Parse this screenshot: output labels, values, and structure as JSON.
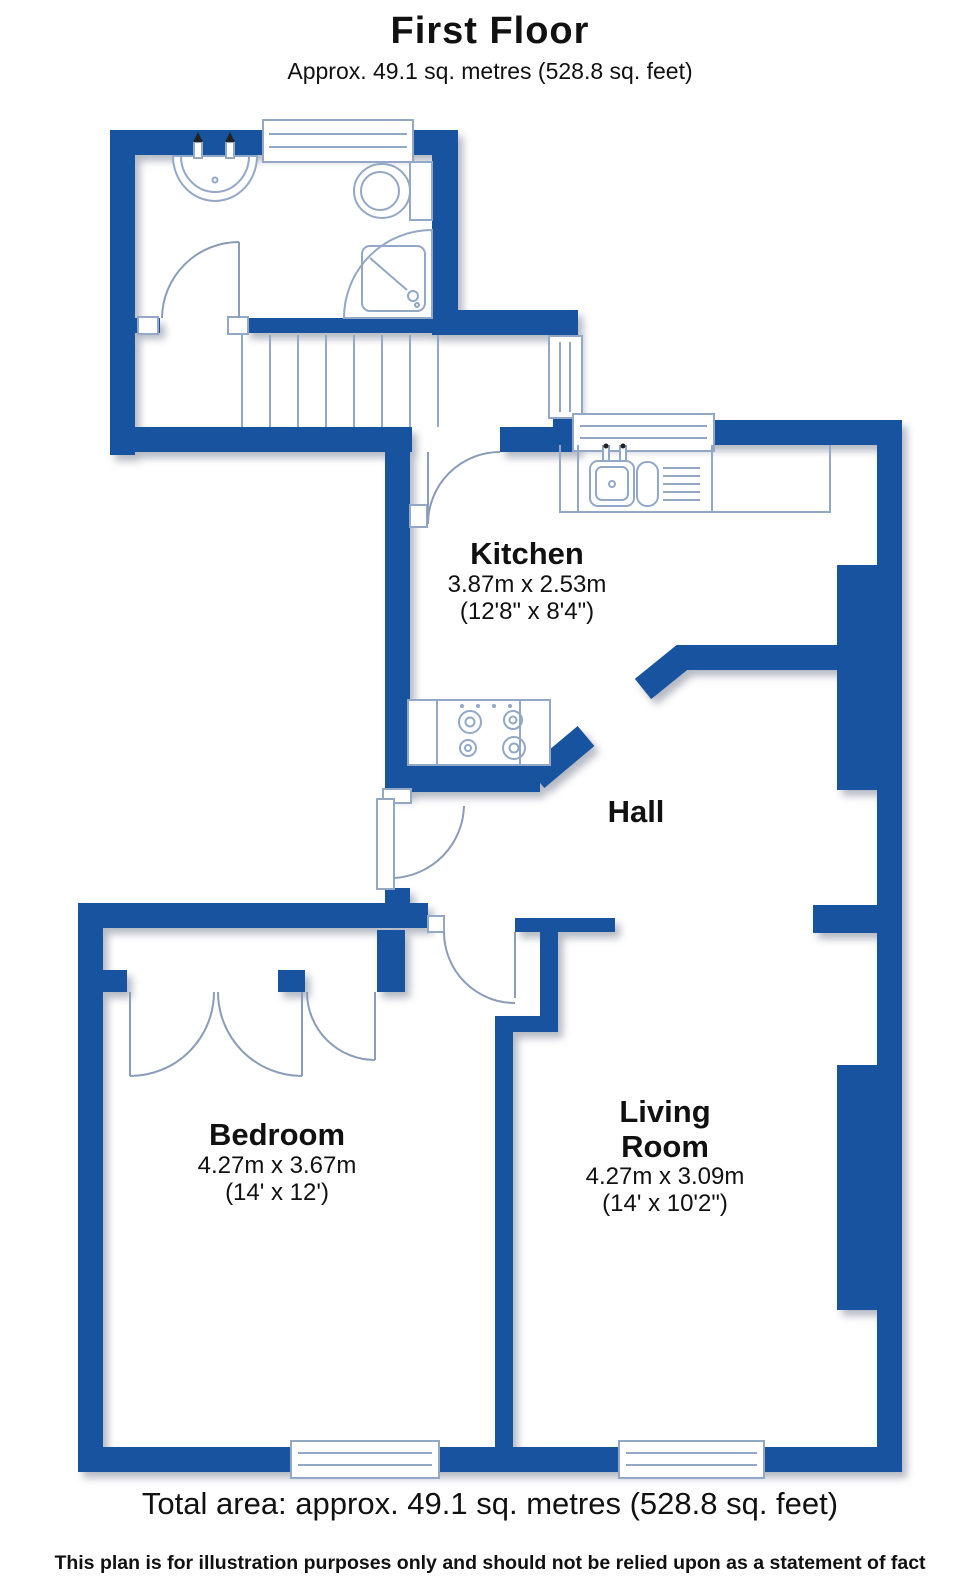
{
  "header": {
    "title": "First Floor",
    "subtitle": "Approx. 49.1 sq. metres (528.8 sq. feet)"
  },
  "rooms": {
    "kitchen": {
      "name": "Kitchen",
      "metric": "3.87m x 2.53m",
      "imperial": "(12'8\" x 8'4\")"
    },
    "hall": {
      "name": "Hall"
    },
    "bedroom": {
      "name": "Bedroom",
      "metric": "4.27m x 3.67m",
      "imperial": "(14' x 12')"
    },
    "living_room": {
      "name": "Living Room",
      "metric": "4.27m x 3.09m",
      "imperial": "(14' x 10'2\")"
    }
  },
  "footer": {
    "total_area": "Total area: approx. 49.1 sq. metres (528.8 sq. feet)",
    "disclaimer": "This plan is for illustration purposes only and should not be relied upon as a statement of fact"
  },
  "colors": {
    "wall": "#1853A0",
    "fixture_line": "#93a7c6",
    "text": "#111111",
    "background": "#ffffff"
  }
}
